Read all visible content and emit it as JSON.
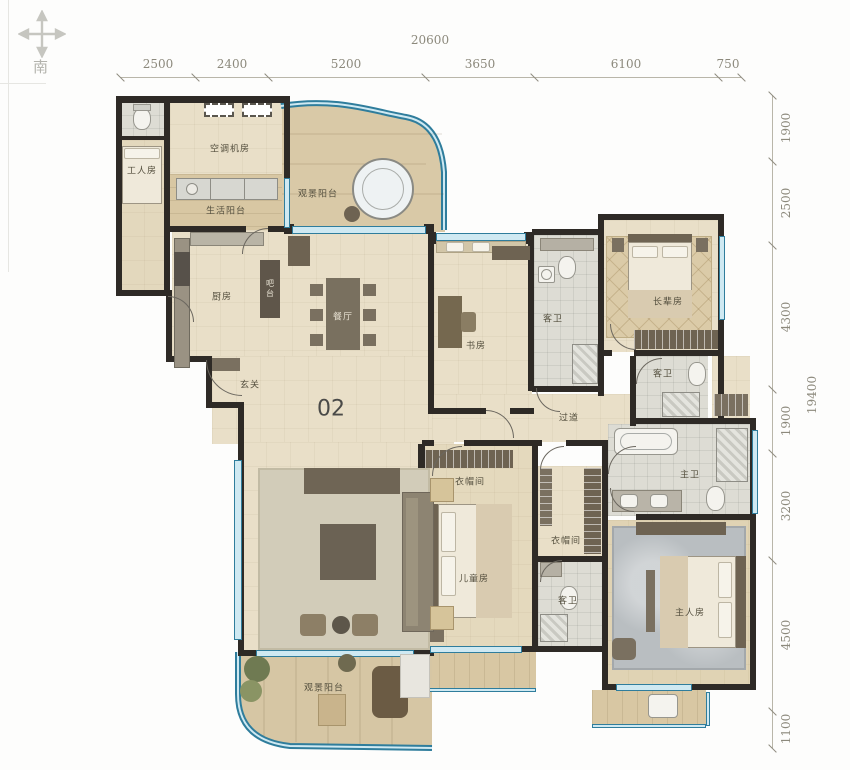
{
  "unit": {
    "number": "02"
  },
  "compass": {
    "south_label": "南"
  },
  "dimensions": {
    "top": {
      "total": "20600",
      "segments": [
        "2500",
        "2400",
        "5200",
        "3650",
        "6100",
        "750"
      ]
    },
    "right": {
      "total": "19400",
      "segments": [
        "1900",
        "2500",
        "4300",
        "1900",
        "3200",
        "4500",
        "1100"
      ]
    }
  },
  "rooms": [
    {
      "id": "worker-room",
      "label": "工人房"
    },
    {
      "id": "hvac-room",
      "label": "空调机房"
    },
    {
      "id": "service-balcony",
      "label": "生活阳台"
    },
    {
      "id": "north-balcony",
      "label": "观景阳台"
    },
    {
      "id": "kitchen",
      "label": "厨房"
    },
    {
      "id": "bar-counter",
      "label": "吧台"
    },
    {
      "id": "dining-room",
      "label": "餐厅"
    },
    {
      "id": "foyer",
      "label": "玄关"
    },
    {
      "id": "study",
      "label": "书房"
    },
    {
      "id": "guest-bath-1",
      "label": "客卫"
    },
    {
      "id": "elders-room",
      "label": "长辈房"
    },
    {
      "id": "guest-bath-2",
      "label": "客卫"
    },
    {
      "id": "corridor",
      "label": "过道"
    },
    {
      "id": "cloakroom-1",
      "label": "衣帽间"
    },
    {
      "id": "kids-room",
      "label": "儿童房"
    },
    {
      "id": "cloakroom-2",
      "label": "衣帽间"
    },
    {
      "id": "guest-bath-3",
      "label": "客卫"
    },
    {
      "id": "living-room",
      "label": "客厅"
    },
    {
      "id": "master-bath",
      "label": "主卫"
    },
    {
      "id": "master-bedroom",
      "label": "主人房"
    },
    {
      "id": "south-balcony",
      "label": "观景阳台"
    }
  ],
  "colors": {
    "wall": "#2e2a26",
    "window": "#2f7d9c",
    "window_fill": "#cfe9f2",
    "floor": "#e9dfc8",
    "wood": "#d8c7a3",
    "tile": "#dddcd4"
  }
}
